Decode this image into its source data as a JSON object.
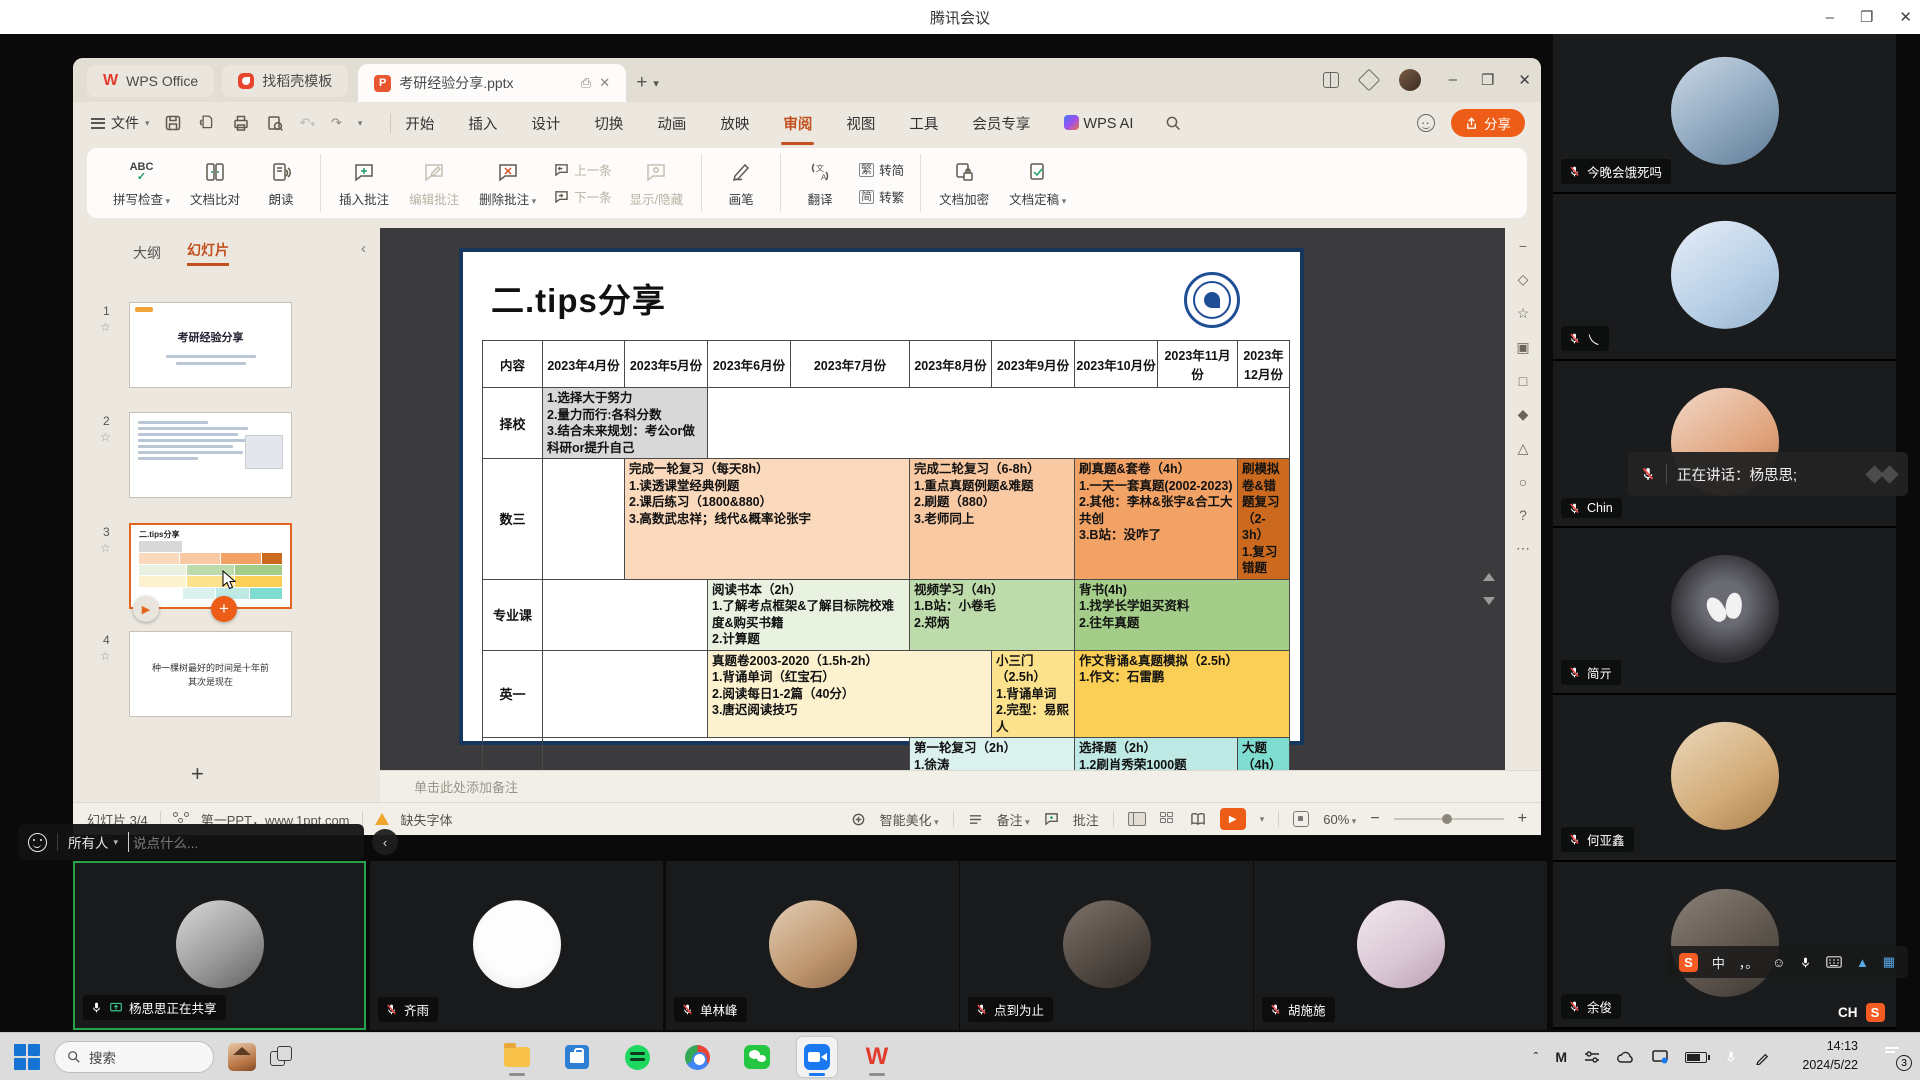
{
  "meeting": {
    "title": "腾讯会议",
    "share_banner": "杨思思的屏幕共享",
    "speaking_toast": "正在讲话：杨思思;",
    "chat": {
      "audience": "所有人",
      "placeholder": "说点什么..."
    },
    "bottom_participants": [
      {
        "name": "杨思思正在共享"
      },
      {
        "name": "齐雨"
      },
      {
        "name": "单林峰"
      },
      {
        "name": "点到为止"
      },
      {
        "name": "胡施施"
      }
    ],
    "side_participants": [
      {
        "name": "今晚会饿死吗"
      },
      {
        "name": "乀"
      },
      {
        "name": "Chin"
      },
      {
        "name": "简亓"
      },
      {
        "name": "何亚鑫"
      },
      {
        "name": "余俊"
      }
    ]
  },
  "wps": {
    "tabs": {
      "home": "WPS Office",
      "docer": "找稻壳模板",
      "document": "考研经验分享.pptx"
    },
    "menubar": {
      "file": "文件",
      "items": [
        "开始",
        "插入",
        "设计",
        "切换",
        "动画",
        "放映",
        "审阅",
        "视图",
        "工具",
        "会员专享"
      ],
      "ai": "WPS AI",
      "share": "分享"
    },
    "ribbon": {
      "spell_check": "拼写检查",
      "doc_compare": "文档比对",
      "read_aloud": "朗读",
      "insert_comment": "插入批注",
      "edit_comment": "编辑批注",
      "delete_comment": "删除批注",
      "prev_comment": "上一条",
      "next_comment": "下一条",
      "show_hide": "显示/隐藏",
      "pen": "画笔",
      "translate": "翻译",
      "trad_badge": "繁",
      "trad_to_simp": "转简",
      "simp_badge": "简",
      "simp_to_trad": "转繁",
      "encrypt": "文档加密",
      "finalize": "文档定稿"
    },
    "left_panel": {
      "outline_tab": "大纲",
      "slides_tab": "幻灯片",
      "thumb1_title": "考研经验分享",
      "thumb4_text": "种一棵树最好的时间是十年前\n其次是现在"
    },
    "notes_placeholder": "单击此处添加备注",
    "statusbar": {
      "slide_pos": "幻灯片 3/4",
      "source": "第一PPT，www.1ppt.com",
      "missing_font": "缺失字体",
      "beautify": "智能美化",
      "notes": "备注",
      "comments": "批注",
      "zoom": "60%"
    }
  },
  "slide": {
    "title": "二.tips分享",
    "table": {
      "header": [
        "内容",
        "2023年4月份",
        "2023年5月份",
        "2023年6月份",
        "2023年7月份",
        "2023年8月份",
        "2023年9月份",
        "2023年10月份",
        "2023年11月份",
        "2023年12月份"
      ],
      "rows": [
        {
          "label": "择校",
          "cells": [
            {
              "span": 2,
              "bg": "#d8d8d8",
              "text": "1.选择大于努力\n2.量力而行:各科分数\n3.结合未来规划：考公or做科研or提升自己"
            },
            {
              "span": 7,
              "bg": "",
              "text": ""
            }
          ]
        },
        {
          "label": "数三",
          "cells": [
            {
              "span": 1,
              "bg": "",
              "text": ""
            },
            {
              "span": 3,
              "bg": "#fbd9bc",
              "text": "完成一轮复习（每天8h）\n1.读透课堂经典例题\n2.课后练习（1800&880）\n3.高数武忠祥；线代&概率论张宇"
            },
            {
              "span": 2,
              "bg": "#f9c9a3",
              "text": "完成二轮复习（6-8h）\n1.重点真题例题&难题\n2.刷题（880）\n3.老师同上"
            },
            {
              "span": 2,
              "bg": "#f2a265",
              "text": "刷真题&套卷（4h）\n1.一天一套真题(2002-2023)\n2.其他：李林&张宇&合工大共创\n3.B站：没咋了"
            },
            {
              "span": 1,
              "bg": "#cb6a1e",
              "text": "刷模拟卷&错题复习（2-3h）\n1.复习错题"
            }
          ]
        },
        {
          "label": "专业课",
          "cells": [
            {
              "span": 2,
              "bg": "",
              "text": ""
            },
            {
              "span": 2,
              "bg": "#e9f2e1",
              "text": "阅读书本（2h）\n1.了解考点框架&了解目标院校难度&购买书籍\n2.计算题"
            },
            {
              "span": 2,
              "bg": "#bedcab",
              "text": "视频学习（4h）\n1.B站：小卷毛\n2.郑炳"
            },
            {
              "span": 3,
              "bg": "#a3cd88",
              "text": "背书(4h)\n1.找学长学姐买资料\n2.往年真题"
            }
          ]
        },
        {
          "label": "英一",
          "cells": [
            {
              "span": 2,
              "bg": "",
              "text": ""
            },
            {
              "span": 3,
              "bg": "#fdf2cf",
              "text": "真题卷2003-2020（1.5h-2h）\n1.背诵单词（红宝石）\n2.阅读每日1-2篇（40分）\n3.唐迟阅读技巧"
            },
            {
              "span": 1,
              "bg": "#fce28c",
              "text": "小三门（2.5h）\n1.背诵单词\n2.完型：易熙人"
            },
            {
              "span": 3,
              "bg": "#fbce55",
              "text": "作文背诵&真题模拟（2.5h）\n1.作文：石雷鹏"
            }
          ]
        },
        {
          "label": "政治",
          "cells": [
            {
              "span": 4,
              "bg": "",
              "text": ""
            },
            {
              "span": 2,
              "bg": "#daf1ee",
              "text": "第一轮复习（2h）\n1.徐涛\n2.肖秀荣1000题"
            },
            {
              "span": 2,
              "bg": "#bfe9e4",
              "text": "选择题（2h）\n1.2刷肖秀荣1000题\n2.肖8选择题（2-3刷）"
            },
            {
              "span": 1,
              "bg": "#7eddd0",
              "text": "大题（4h）\n1.肖4选择题\n2.肖4大题"
            }
          ]
        }
      ]
    }
  },
  "taskbar": {
    "search": "搜索",
    "time": "14:13",
    "date": "2024/5/22",
    "notification_count": "3",
    "ime_mode": "中",
    "ime_punct": "，。",
    "ime_indicator": "CH",
    "ime_logo": "S"
  }
}
